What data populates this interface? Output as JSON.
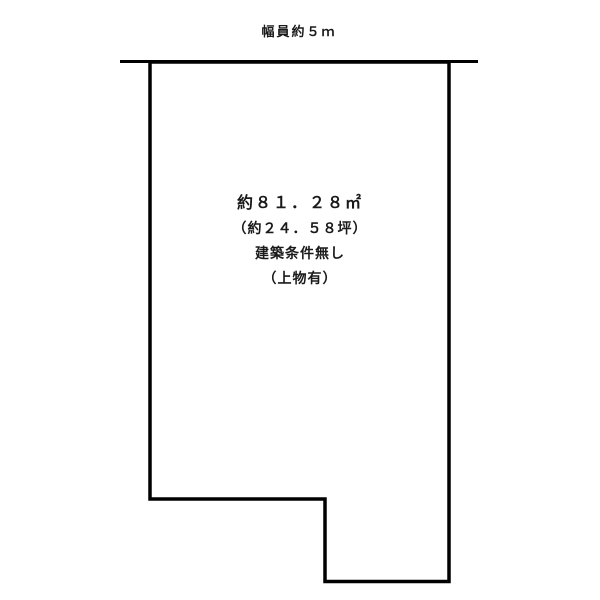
{
  "page": {
    "background": "#ffffff",
    "line_color": "#000000",
    "text_color": "#1a1a1a"
  },
  "road": {
    "width_label": "幅員約５ｍ"
  },
  "plot": {
    "area_sqm": "約８１．２８㎡",
    "area_tsubo": "（約２４．５８坪）",
    "building_condition": "建築条件無し",
    "structure_note": "（上物有）"
  }
}
